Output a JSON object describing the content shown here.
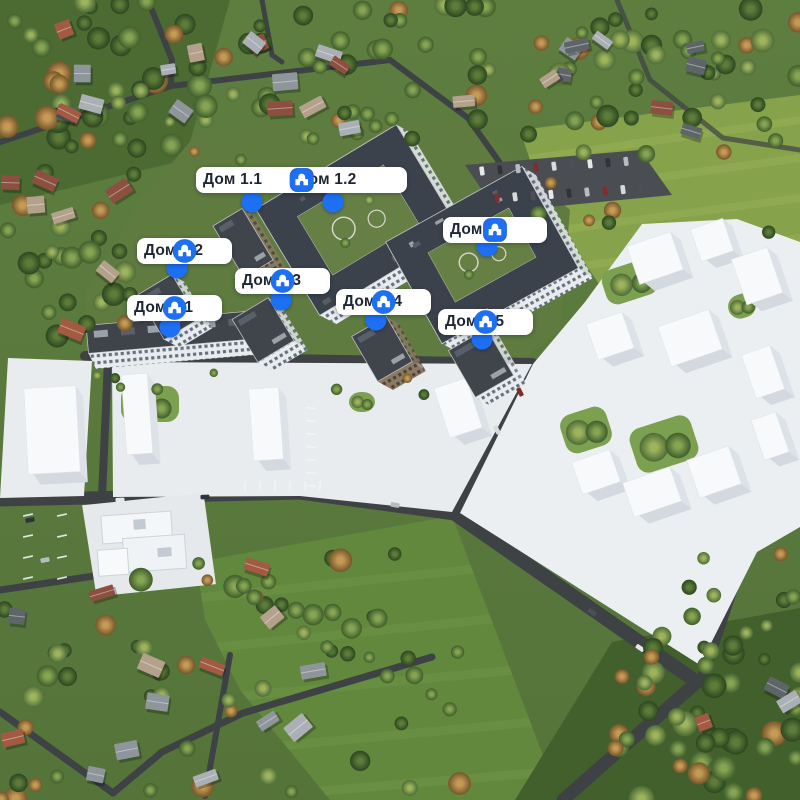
{
  "view": {
    "type": "aerial-genplan",
    "description_labels_language": "ru"
  },
  "colors": {
    "accent_blue": "#1d6ff3",
    "check_badge_blue": "#2a63dd",
    "pill_background": "#ffffff",
    "label_text": "#1d2633"
  },
  "icons_legend": {
    "check": "checkmark-badge-icon",
    "building": "building-circle-icon"
  },
  "marker_groups": [
    {
      "x": 196,
      "y": 167,
      "items": [
        {
          "label": "Дом 1.1",
          "icons": [
            "check"
          ],
          "dot": {
            "x": 252,
            "y": 202
          }
        },
        {
          "label": "Дом 1.2",
          "icons": [
            "check",
            "building"
          ],
          "dot": {
            "x": 333,
            "y": 202
          }
        }
      ]
    },
    {
      "x": 443,
      "y": 217,
      "items": [
        {
          "label": "Дом 2",
          "icons": [
            "check",
            "building"
          ],
          "dot": {
            "x": 487,
            "y": 246
          }
        }
      ]
    },
    {
      "x": 137,
      "y": 238,
      "items": [
        {
          "label": "Дом 3.2",
          "icons": [
            "building"
          ],
          "dot": {
            "x": 177,
            "y": 268
          }
        }
      ]
    },
    {
      "x": 235,
      "y": 268,
      "items": [
        {
          "label": "Дом 3.3",
          "icons": [
            "building"
          ],
          "dot": {
            "x": 281,
            "y": 300
          }
        }
      ]
    },
    {
      "x": 127,
      "y": 295,
      "items": [
        {
          "label": "Дом 3.1",
          "icons": [
            "building"
          ],
          "dot": {
            "x": 170,
            "y": 327
          }
        }
      ]
    },
    {
      "x": 336,
      "y": 289,
      "items": [
        {
          "label": "Дом 3.4",
          "icons": [
            "building"
          ],
          "dot": {
            "x": 376,
            "y": 320
          }
        }
      ]
    },
    {
      "x": 438,
      "y": 309,
      "items": [
        {
          "label": "Дом 3.5",
          "icons": [
            "building"
          ],
          "dot": {
            "x": 482,
            "y": 339
          }
        }
      ]
    }
  ]
}
